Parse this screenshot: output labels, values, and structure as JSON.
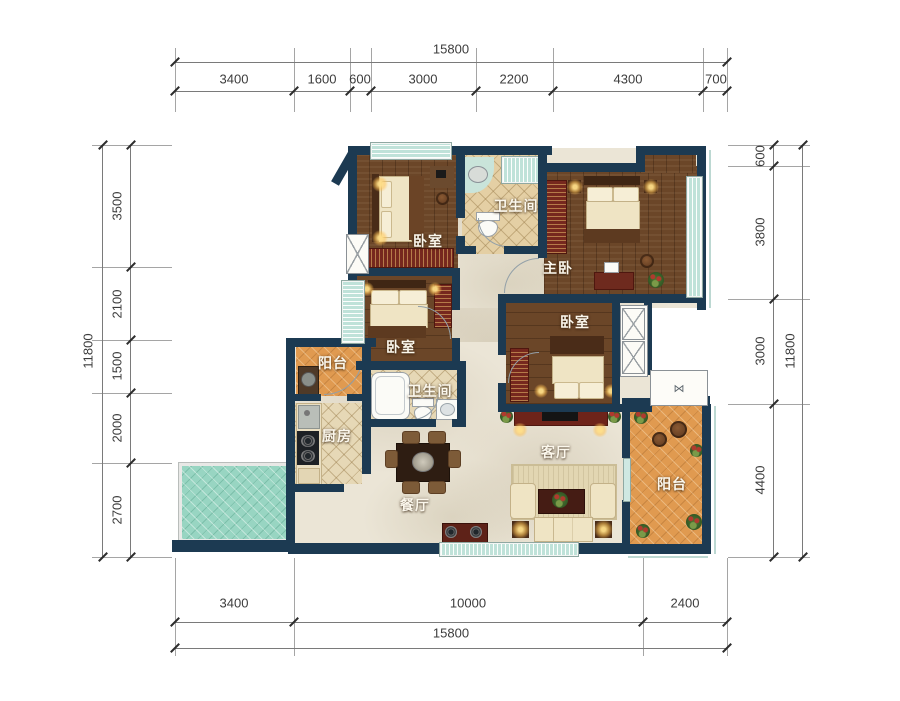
{
  "plan": {
    "rooms": {
      "bedroom_top_left": "卧室",
      "bathroom_top": "卫生间",
      "master_bedroom": "主卧",
      "bedroom_mid_left": "卧室",
      "bedroom_mid_right": "卧室",
      "balcony_left": "阳台",
      "bathroom_mid": "卫生间",
      "kitchen": "厨房",
      "dining": "餐厅",
      "living": "客厅",
      "balcony_right": "阳台"
    },
    "icons": {
      "bay_window": "⋈"
    },
    "colors": {
      "wall": "#1c3a52",
      "wood_floor": "#6b4628",
      "tile_floor": "#e6d8b6",
      "marble_floor": "#ebe5d6",
      "balcony_floor": "#e09a50",
      "teal_patio": "#98d5c2",
      "window": "#bfe2d9",
      "wardrobe": "#76281e"
    }
  },
  "dims": {
    "top": {
      "total": "15800",
      "segments": [
        "3400",
        "1600",
        "600",
        "3000",
        "2200",
        "4300",
        "700"
      ]
    },
    "bottom": {
      "total": "15800",
      "segments": [
        "3400",
        "10000",
        "2400"
      ]
    },
    "left": {
      "total": "11800",
      "segments": [
        "3500",
        "2100",
        "1500",
        "2000",
        "2700"
      ]
    },
    "right": {
      "total": "11800",
      "segments": [
        "600",
        "3800",
        "3000",
        "4400"
      ]
    }
  }
}
